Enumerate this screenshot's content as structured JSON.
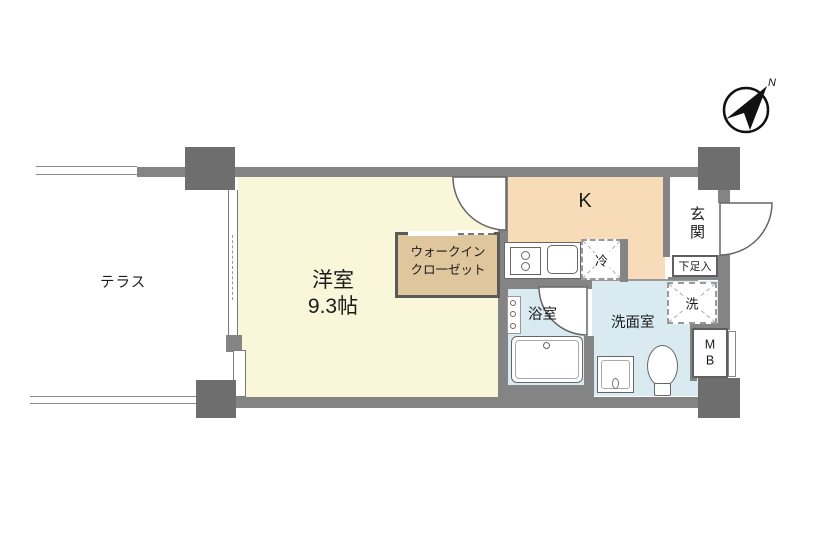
{
  "plan": {
    "compass": {
      "label": "N"
    },
    "terrace": {
      "label": "テラス"
    },
    "living_room": {
      "label": "洋室",
      "size": "9.3帖"
    },
    "walk_in_closet": {
      "label_line1": "ウォークイン",
      "label_line2": "クロ一ゼット"
    },
    "kitchen": {
      "label": "K"
    },
    "refrigerator": {
      "label": "冷"
    },
    "entrance": {
      "label": "玄関"
    },
    "shoe_cabinet": {
      "label": "下足入"
    },
    "bathroom": {
      "label": "浴室"
    },
    "washroom": {
      "label": "洗面室"
    },
    "washer": {
      "label": "洗"
    },
    "meter_box": {
      "label_line1": "M",
      "label_line2": "B"
    }
  },
  "colors": {
    "room_cream": "#f9f6da",
    "kitchen_peach": "#f8dcba",
    "closet_tan": "#e0c69c",
    "water_blue": "#d9ebf1",
    "wall_gray": "#848484",
    "pillar_gray": "#6e6e6e",
    "line_dark": "#666666"
  }
}
